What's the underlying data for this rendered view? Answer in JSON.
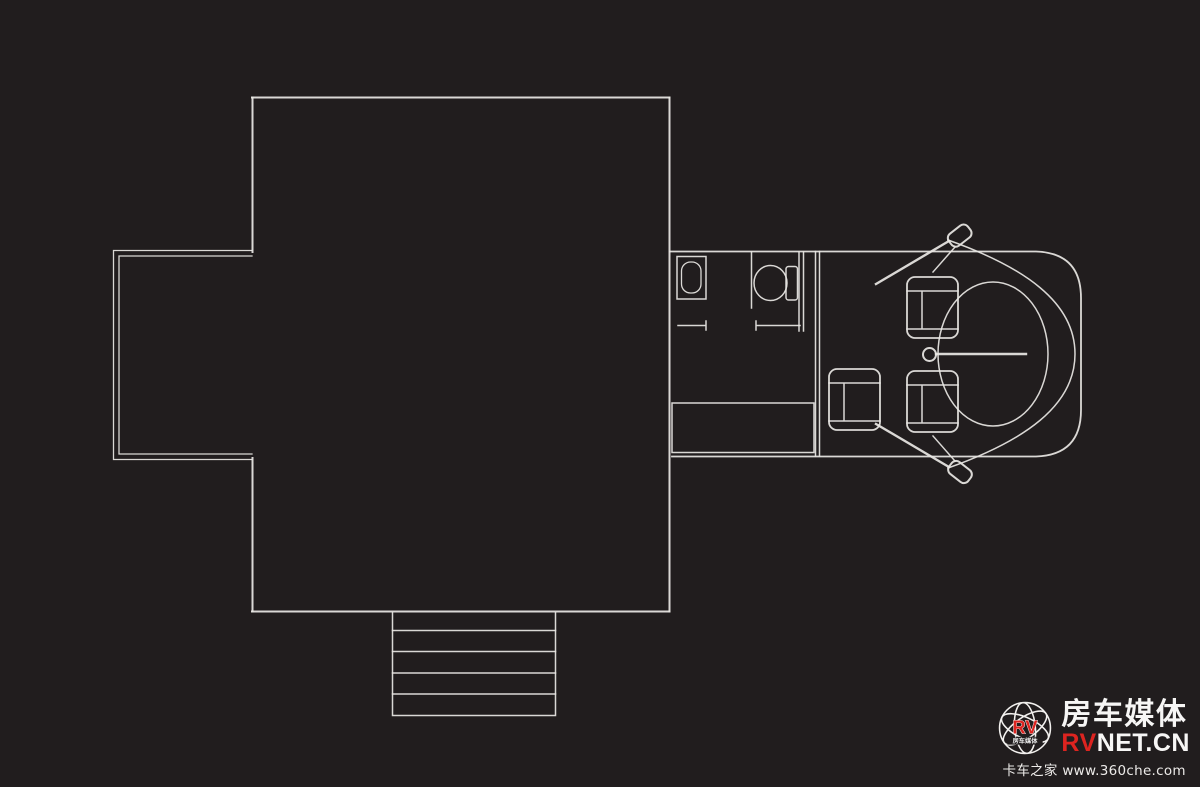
{
  "colors": {
    "background": "#211d1e",
    "line": "#e8e6e3",
    "logo_red": "#dd2420",
    "logo_white": "#f7f6f5"
  },
  "floorplan": {
    "features": [
      "main-room",
      "slide-out-extension",
      "entry-stairs",
      "bathroom-sink",
      "toilet",
      "entry-step-cabinet",
      "cab-body",
      "windshield-curve",
      "engine-cover",
      "steering-wheel",
      "driver-seat",
      "passenger-seat",
      "side-seat",
      "side-mirror-top",
      "side-mirror-bottom"
    ]
  },
  "watermark": {
    "badge_text": "RV",
    "badge_subtext": "房车媒体",
    "brand_cn": "房车媒体",
    "brand_en_red": "RV",
    "brand_en_white": "NET.CN",
    "tagline": "卡车之家 www.360che.com"
  }
}
